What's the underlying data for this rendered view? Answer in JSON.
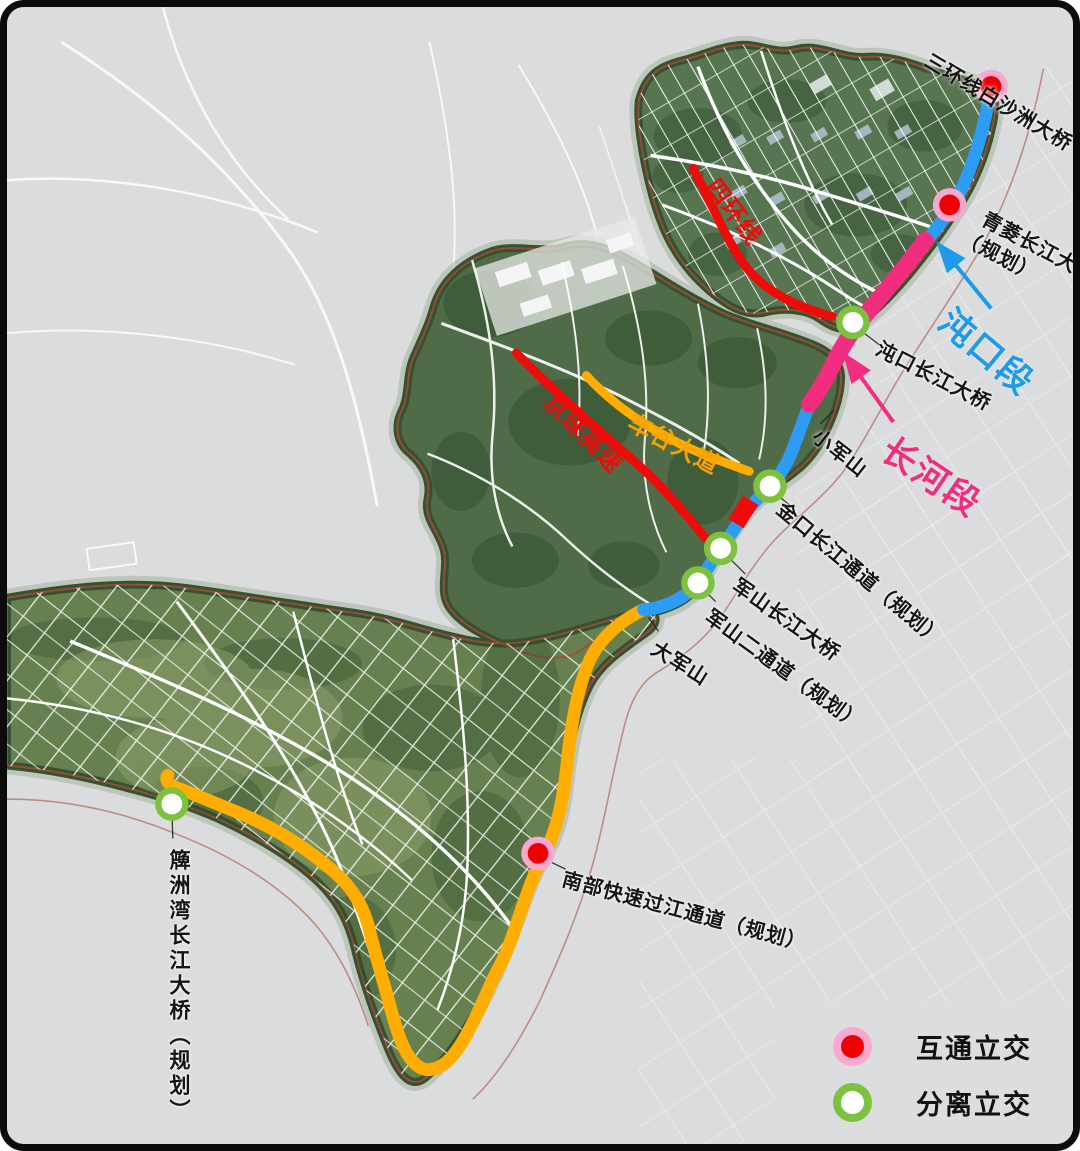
{
  "colors": {
    "route_blue": "#2D9CF4",
    "route_pink": "#F22C7E",
    "route_orange": "#FFAE00",
    "road_red": "#F00A0A",
    "section_label_blue": "#1E9BE8",
    "section_label_pink": "#F22C7E",
    "road_label_orange": "#F5A300",
    "interchange_fill": "#EE0000",
    "interchange_ring": "#F9A9CF",
    "separation_fill": "#FFFFFF",
    "separation_ring": "#7CC23F"
  },
  "labels": {
    "sanhuan": "三环线白沙洲大桥",
    "qingling_line1": "青菱长江大桥",
    "qingling_line2": "（规划）",
    "dunkou_section": "沌口段",
    "dunkou_bridge": "沌口长江大桥",
    "changhe_section": "长河段",
    "xiaojunshan": "小军山",
    "jinkou_tunnel": "金口长江通道（规划）",
    "junshan_bridge": "军山长江大桥",
    "junshan_second": "军山二通道（规划）",
    "dajunshan": "大军山",
    "nanbu_crossing": "南部快速过江通道（规划）",
    "paizhouwan_bridge": "簰洲湾长江大桥（规划）",
    "fourth_ring": "四环线",
    "jingzhu_expressway": "京珠高速",
    "chegu_avenue": "车谷大道"
  },
  "legend": {
    "interchange": "互通立交",
    "separation": "分离立交"
  }
}
